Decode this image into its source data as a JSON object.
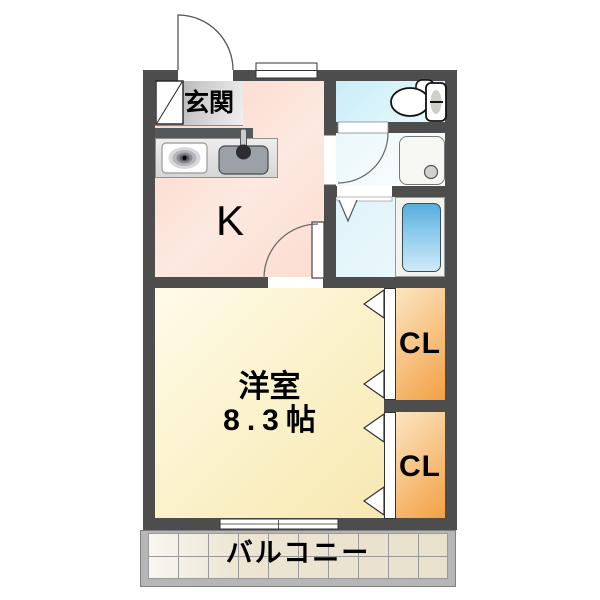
{
  "plan": {
    "type": "japanese-apartment-floor-plan",
    "rooms": {
      "genkan": {
        "label": "玄関"
      },
      "kitchen": {
        "label": "K"
      },
      "main": {
        "label": "洋室",
        "size": "8.3帖"
      },
      "closet_top": {
        "label": "CL"
      },
      "closet_bottom": {
        "label": "CL"
      },
      "balcony": {
        "label": "バルコニー"
      }
    },
    "icons": {
      "toilet": "toilet-icon",
      "bathtub": "bathtub-icon",
      "washer_pan": "washer-pan-icon",
      "stove": "stove-burner-icon",
      "sink": "kitchen-sink-icon",
      "shoe_cabinet": "shoe-cabinet-icon",
      "swing_doors": "door-swing-arc-icon",
      "folding_doors": "folding-door-chevron-icon",
      "sliding_window": "sliding-window-icon"
    },
    "colors": {
      "wall": "#4d4d4d",
      "kitchen_floor": "#fbdacb",
      "genkan_floor": "#bdbdbd",
      "main_room_floor": "#fbf1c9",
      "closet_floor": "#f5ab52",
      "toilet_floor": "#cdeef8",
      "washroom_floor": "#f2fbfd",
      "bathroom_floor": "#e6f5fa",
      "bathtub": "#5fb3e2",
      "balcony_tile": "#e9e2cd",
      "balcony_rail": "#b6b6b6"
    }
  }
}
